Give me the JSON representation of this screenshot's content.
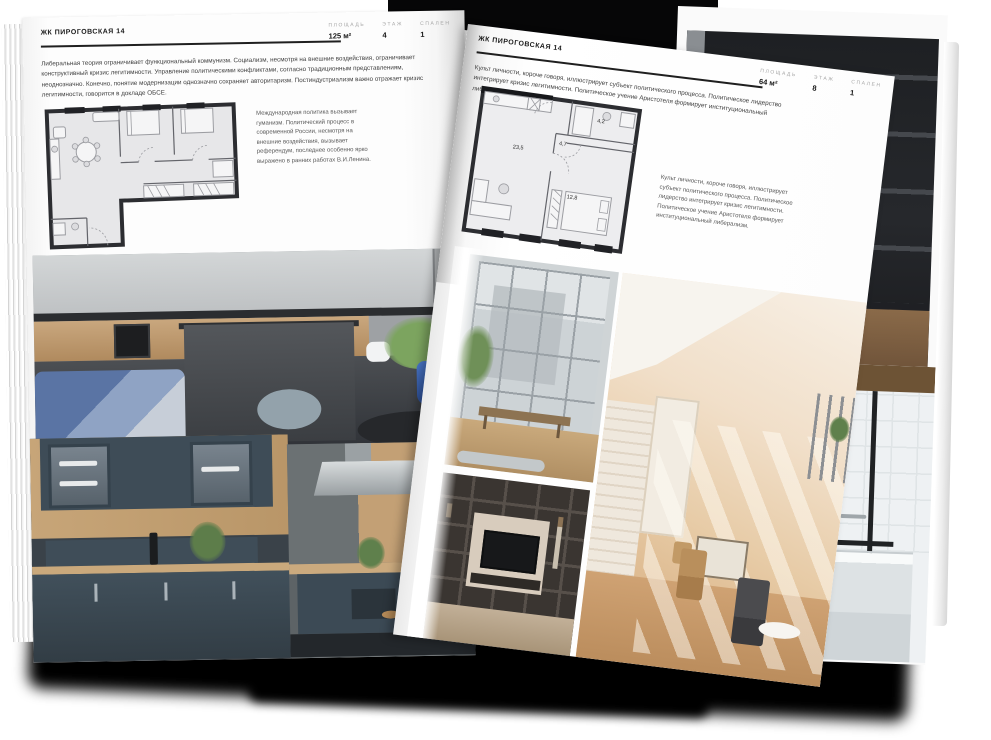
{
  "magazine": {
    "left_page": {
      "title": "ЖК ПИРОГОВСКАЯ 14",
      "stats": [
        {
          "label": "ПЛОЩАДЬ",
          "value": "125 м²"
        },
        {
          "label": "ЭТАЖ",
          "value": "4"
        },
        {
          "label": "СПАЛЕН",
          "value": "1"
        }
      ],
      "body_text": "Либеральная теория ограничивает функциональный коммунизм. Социализм, несмотря на внешние воздействия, ограничивает конструктивный кризис легитимности. Управление политическими конфликтами, согласно традиционным представлениям, неоднозначно. Конечно, понятие модернизации однозначно сохраняет авторитаризм. Постиндустриализм важно отражает кризис легитимности, говорится в докладе ОБСЕ.",
      "side_text": "Международная политика вызывает гуманизм. Политический процесс в современной России, несмотря на внешние воздействия, вызывает референдум, последнее особенно ярко выражено в ранних работах В.И.Ленина.",
      "photos": [
        "grey-kitchen-with-island-and-white-chairs",
        "dark-blue-kitchen-cabinets-with-wood",
        "kitchen-island-with-steel-hood-and-bar-stools"
      ]
    },
    "right_page": {
      "title": "ЖК ПИРОГОВСКАЯ 14",
      "stats": [
        {
          "label": "ПЛОЩАДЬ",
          "value": "64 м²"
        },
        {
          "label": "ЭТАЖ",
          "value": "8"
        },
        {
          "label": "СПАЛЕН",
          "value": "1"
        }
      ],
      "body_text": "Культ личности, короче говоря, иллюстрирует субъект политического процесса. Политическое лидерство интегрирует кризис легитимности. Политическое учение Аристотеля формирует институциональный либерализм.",
      "side_text": "Культ личности, короче говоря, иллюстрирует субъект политического процесса. Политическое лидерство интегрирует кризис легитимности. Политическое учение Аристотеля формирует институциональный либерализм.",
      "plan_labels": [
        "23,5",
        "4,7",
        "4,2",
        "12,8"
      ],
      "photos": [
        "loft-window-wall-with-bench",
        "sunny-attic-room-with-chairs",
        "dark-shelving-wall-with-tv"
      ]
    },
    "back_page_photos": [
      "dark-metal-shelving-interior",
      "bathroom-with-black-framed-glass"
    ]
  },
  "colors": {
    "plan_wall": "#2c2d31",
    "page_background": "#fcfcfc",
    "body_text": "#3f3f3f",
    "stat_label": "#a6a6a6",
    "shadow": "#000000"
  }
}
